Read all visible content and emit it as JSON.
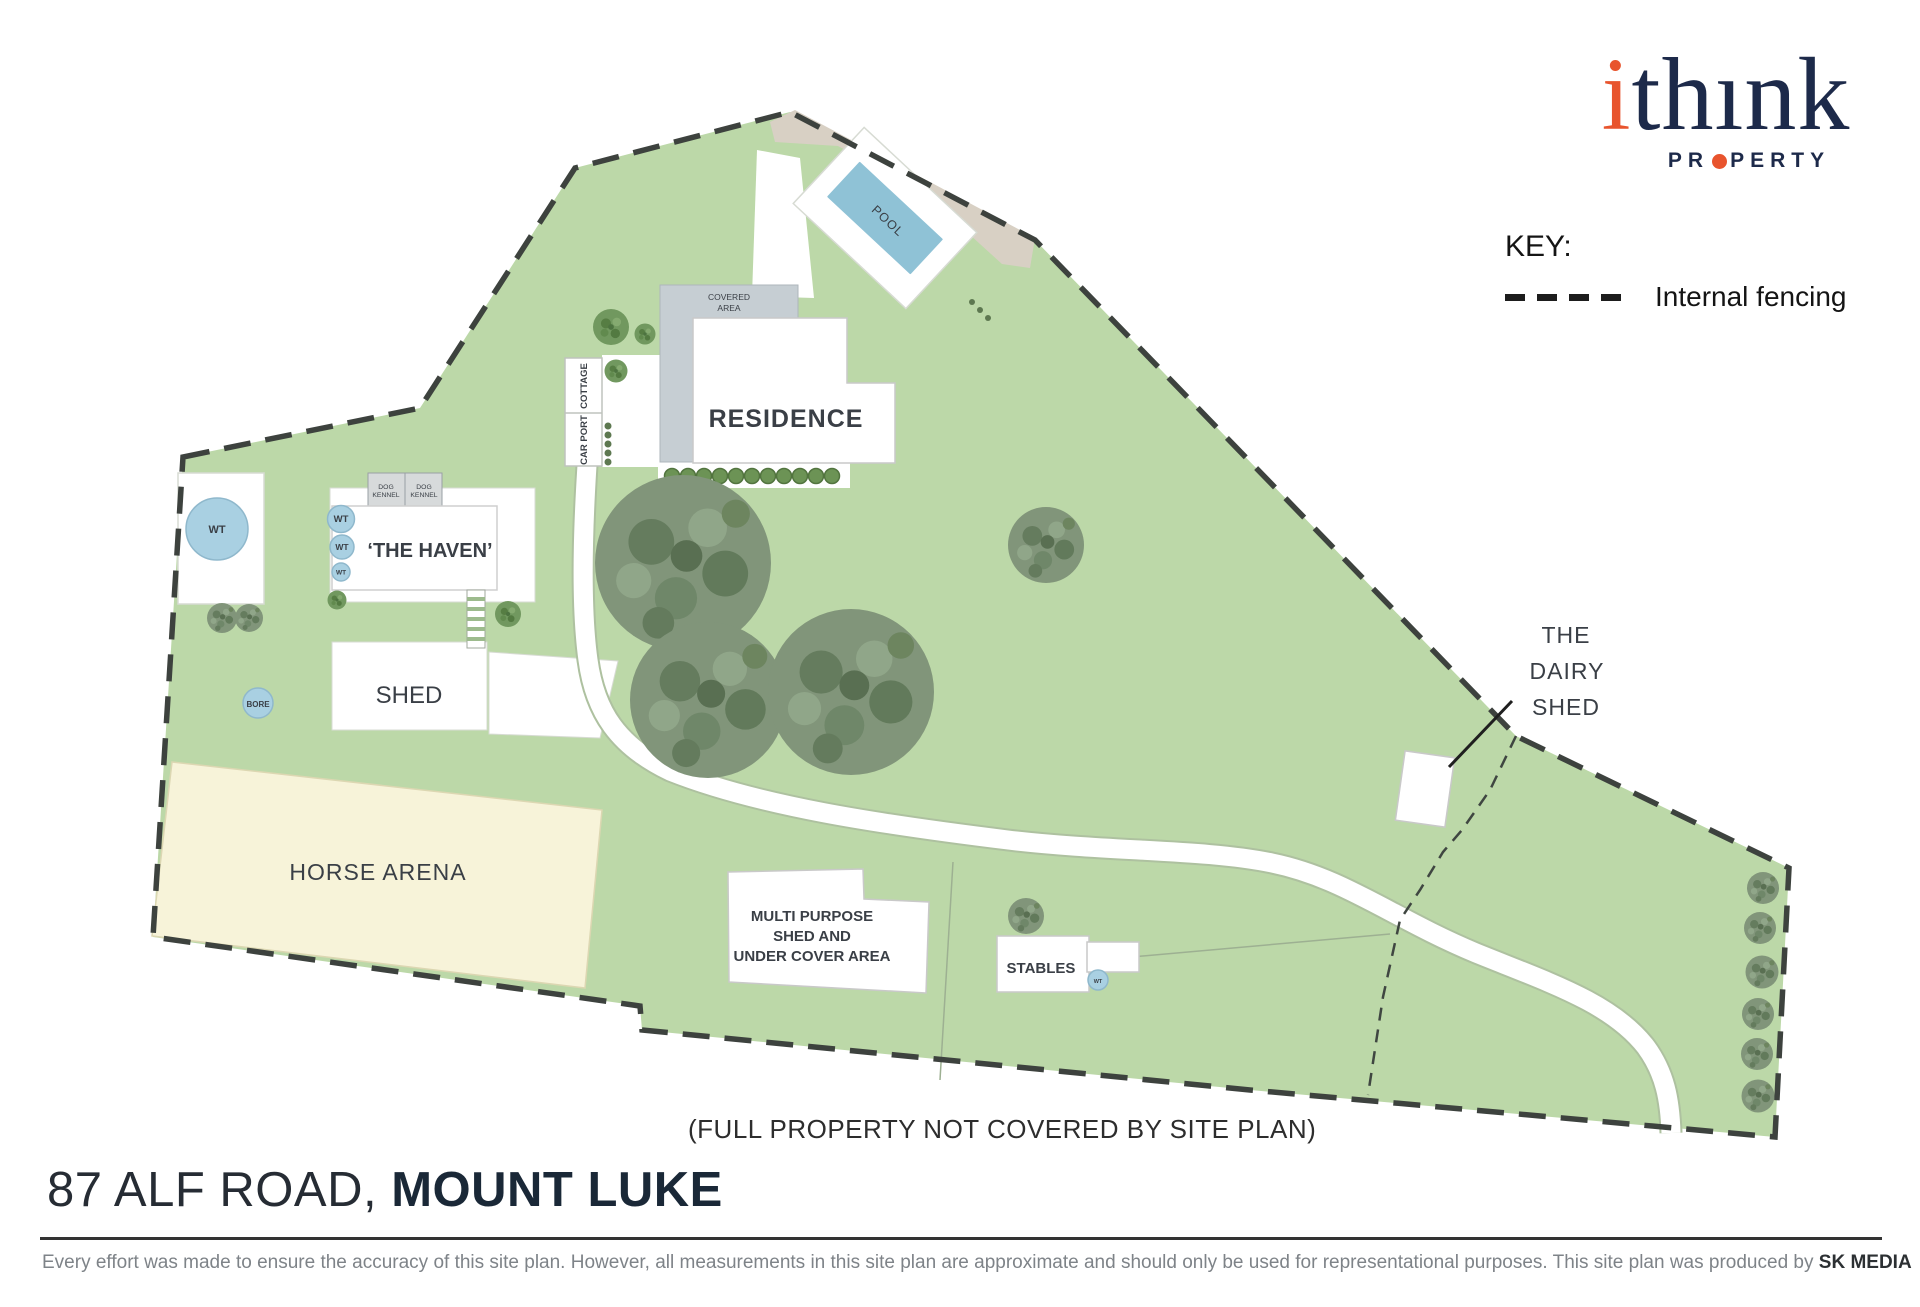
{
  "logo": {
    "part1": "i",
    "part2": "thınk",
    "prop_pre": "PR",
    "prop_post": "PERTY"
  },
  "key": {
    "title": "KEY:",
    "internal_fencing": "Internal fencing"
  },
  "site": {
    "pool": "POOL",
    "covered_area": [
      "COVERED",
      "AREA"
    ],
    "residence": "RESIDENCE",
    "cottage": "COTTAGE",
    "car_port": "CAR PORT",
    "dog_kennel": [
      "DOG",
      "KENNEL"
    ],
    "haven": "‘THE HAVEN’",
    "wt": "WT",
    "shed": "SHED",
    "bore": "BORE",
    "horse_arena": "HORSE ARENA",
    "multi_purpose": [
      "MULTI PURPOSE",
      "SHED AND",
      "UNDER COVER AREA"
    ],
    "stables": "STABLES",
    "dairy": [
      "THE",
      "DAIRY",
      "SHED"
    ],
    "note": "(FULL PROPERTY NOT COVERED BY SITE PLAN)"
  },
  "title": {
    "address": "87 ALF ROAD, ",
    "suburb": "MOUNT LUKE"
  },
  "footer": {
    "disclaimer": "Every effort was made to ensure the accuracy of this site plan. However, all measurements in this site plan are approximate and should only be used for representational purposes. This site plan was produced by ",
    "producer": "SK MEDIA"
  },
  "colors": {
    "grass_green": "#bcd8a8",
    "boundary_dash": "#3d423e",
    "pool_blue": "#8fc2d6",
    "water_tank_blue": "#a9d0e2",
    "covered_gray": "#c6ced3",
    "tan_road": "#d8d0c4",
    "arena_cream": "#f7f3d9",
    "logo_navy": "#1d2a4a",
    "logo_orange": "#e8542d",
    "title_navy": "#1a2837",
    "disclaimer_gray": "#7e8388"
  }
}
